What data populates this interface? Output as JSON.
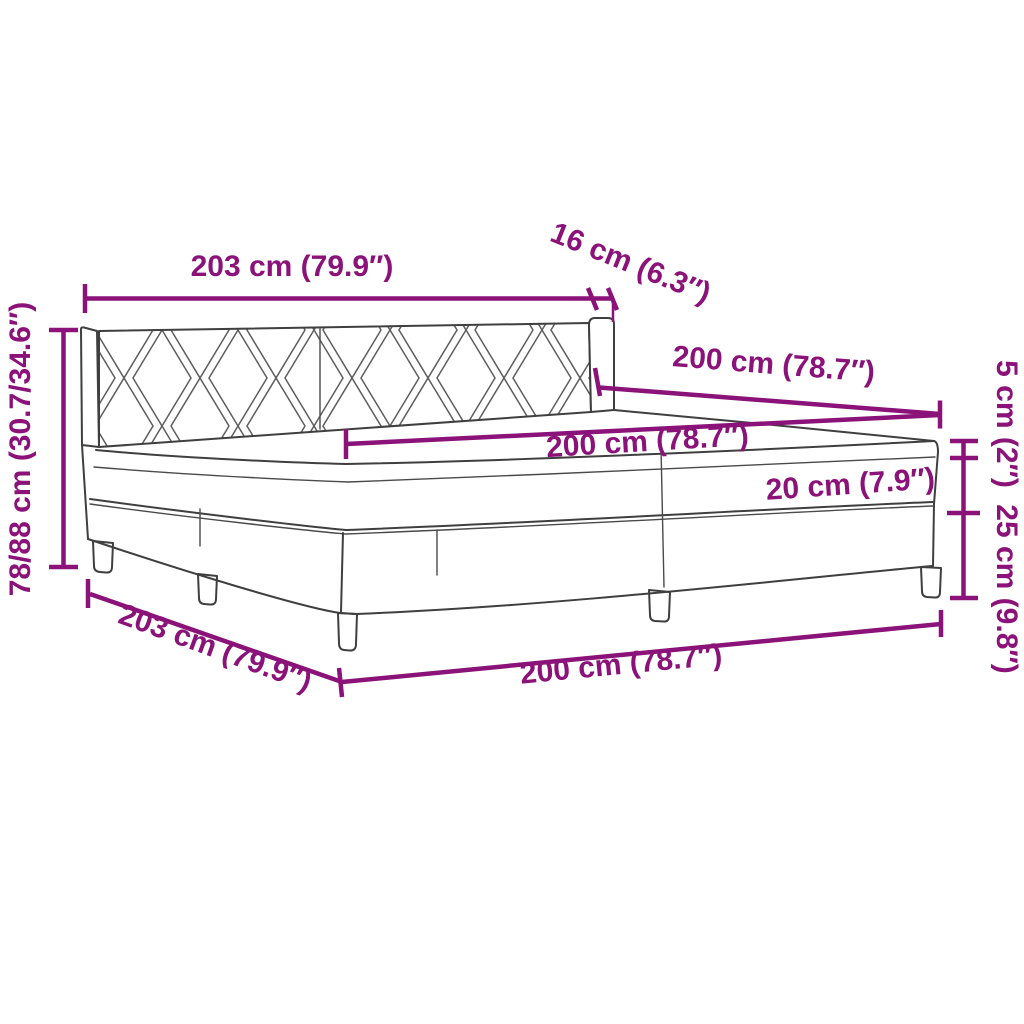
{
  "diagram": {
    "title": "Box spring bed with mattress - dimension diagram",
    "colors": {
      "dimension_accent": "#8A1278",
      "bed_outline": "#3F3F3F",
      "headboard_pattern": "#5E5E5E",
      "background": "#FFFFFF"
    },
    "labels": {
      "headboard_width_top": "203 cm (79.9″)",
      "headboard_depth": "16 cm (6.3″)",
      "bed_length_upper": "200 cm (78.7″)",
      "mattress_width": "200 cm (78.7″)",
      "mattress_height": "20 cm (7.9″)",
      "total_height": "78/88 cm (30.7/34.6″)",
      "topper_height": "5 cm (2″)",
      "box_spring_height": "25 cm (9.8″)",
      "base_width_bottom": "203 cm (79.9″)",
      "base_length_bottom": "200 cm (78.7″)"
    }
  }
}
